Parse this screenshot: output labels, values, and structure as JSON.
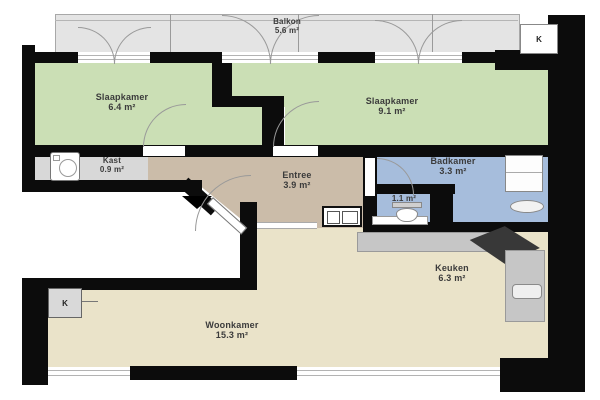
{
  "rooms": {
    "balkon": {
      "name": "Balkon",
      "area": "5.6 m²"
    },
    "slaapkamer1": {
      "name": "Slaapkamer",
      "area": "6.4 m²"
    },
    "slaapkamer2": {
      "name": "Slaapkamer",
      "area": "9.1 m²"
    },
    "kast": {
      "name": "Kast",
      "area": "0.9 m²"
    },
    "entree": {
      "name": "Entree",
      "area": "3.9 m²"
    },
    "badkamer": {
      "name": "Badkamer",
      "area": "3.3 m²"
    },
    "toilet": {
      "area": "1.1 m²"
    },
    "keuken": {
      "name": "Keuken",
      "area": "6.3 m²"
    },
    "woonkamer": {
      "name": "Woonkamer",
      "area": "15.3 m²"
    }
  },
  "markers": {
    "shaft_top_right": "K",
    "shaft_left": "K"
  },
  "colors": {
    "wall": "#0c0c0c",
    "bedroom": "#cbdfb5",
    "bathroom": "#a6bddc",
    "entree": "#cbbca9",
    "living": "#eae3c9",
    "closet": "#d8d8d8",
    "balcony": "#e4e4e4",
    "counter": "#c6c6c6",
    "counter_dark": "#383838",
    "label": "#3b3b3b"
  }
}
